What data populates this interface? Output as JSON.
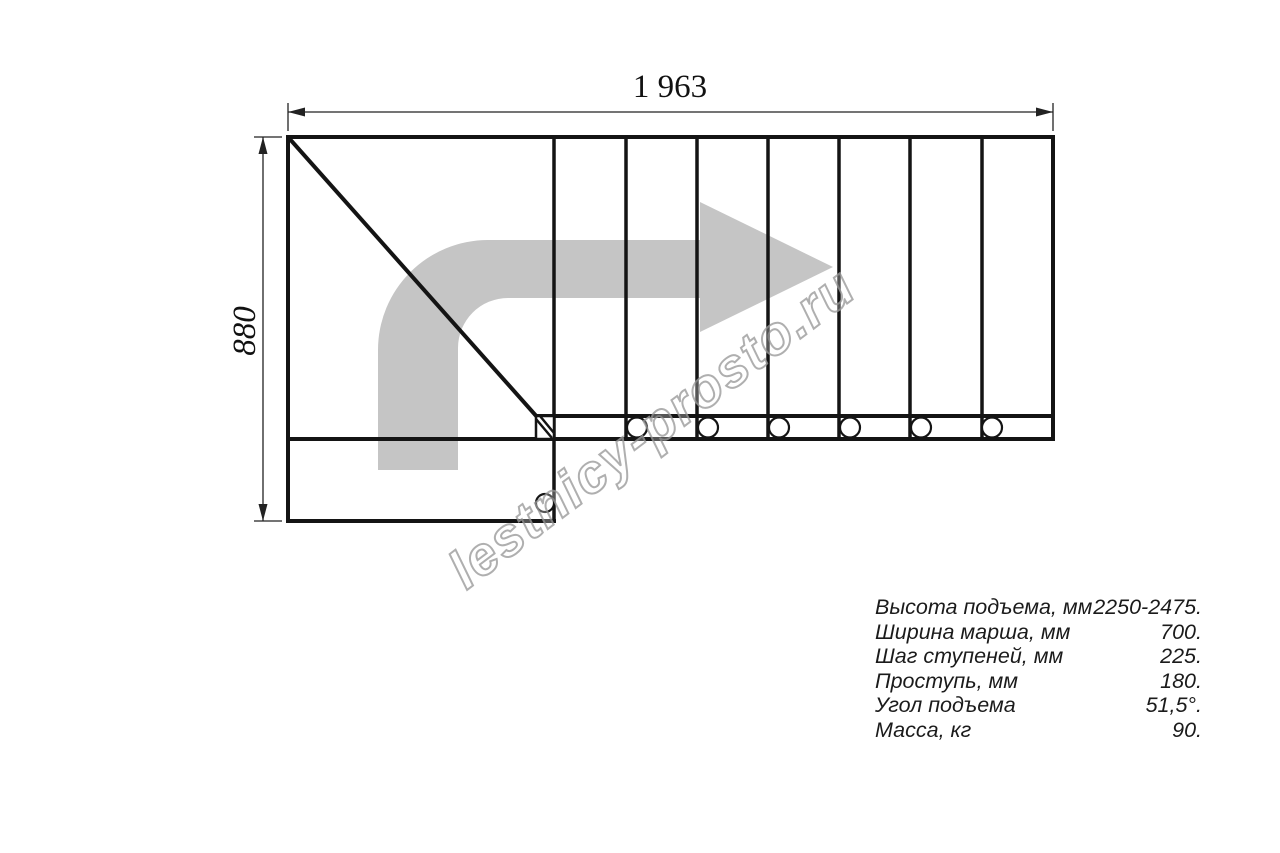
{
  "drawing": {
    "title_implicit": "staircase plan view",
    "dimensions": {
      "overall_length_mm": "1 963",
      "overall_width_mm": "880"
    },
    "tread_count": 7,
    "direction_arrow": "quarter-turn-right-arrow",
    "colors": {
      "line": "#141414",
      "arrow_gray": "#c5c5c5",
      "watermark_gray": "#9c9c9c"
    }
  },
  "watermark": {
    "text": "lestnicy-prosto.ru"
  },
  "specs": {
    "rows": [
      {
        "label": "Высота подъема, мм",
        "value": "2250-2475."
      },
      {
        "label": "Ширина марша, мм",
        "value": "700."
      },
      {
        "label": "Шаг ступеней, мм",
        "value": "225."
      },
      {
        "label": "Проступь, мм",
        "value": "180."
      },
      {
        "label": "Угол подъема",
        "value": "51,5°."
      },
      {
        "label": "Масса, кг",
        "value": "90."
      }
    ]
  }
}
